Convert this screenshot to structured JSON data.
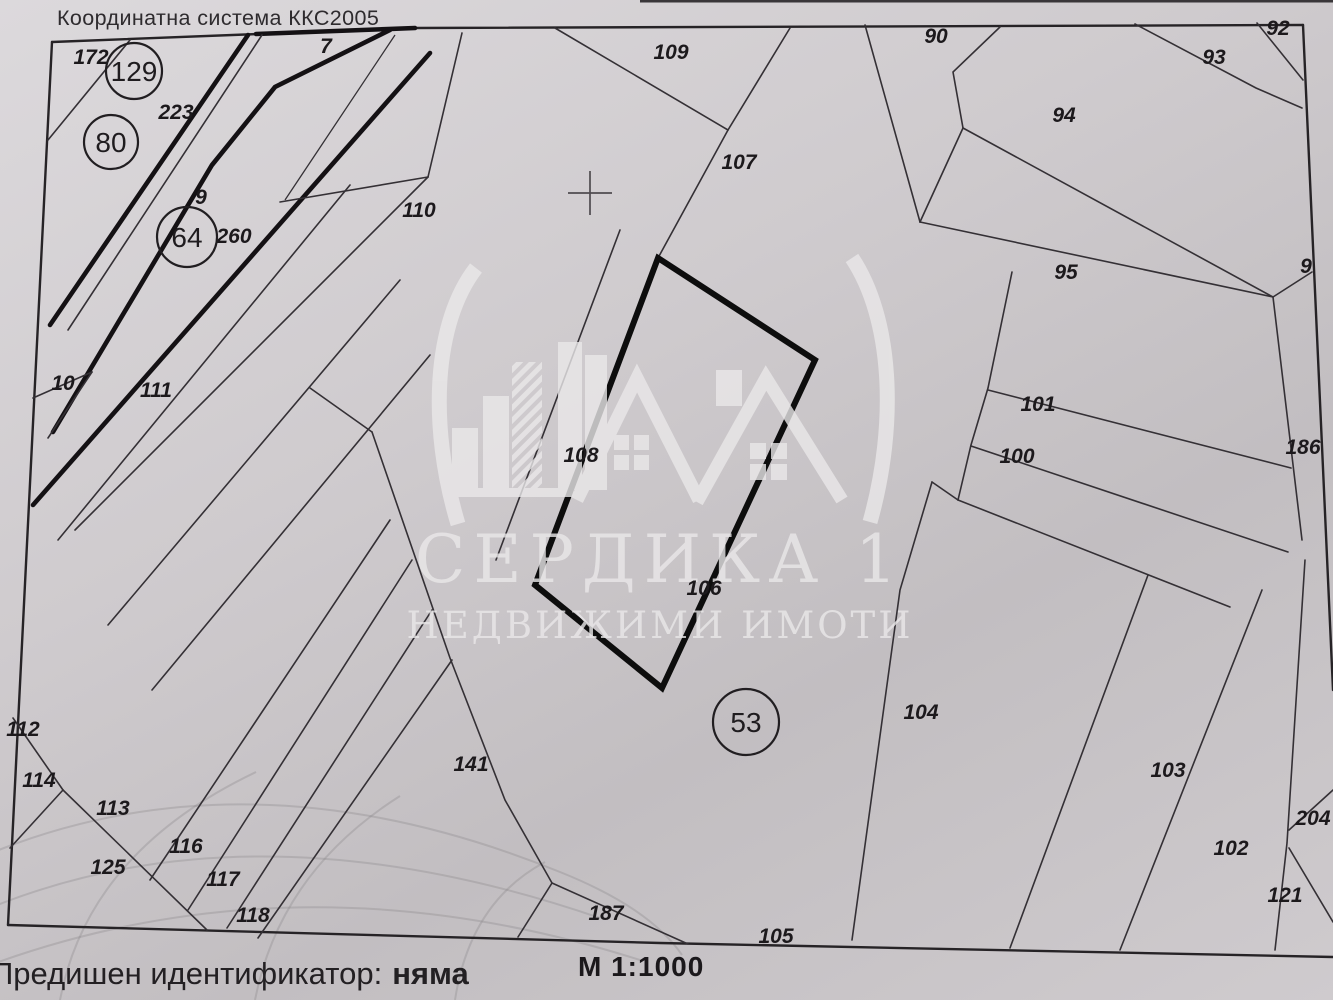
{
  "colors": {
    "paper_light": "#dcd9dc",
    "paper_mid": "#cfcbce",
    "paper_dark": "#c2bec1",
    "ink": "#262326",
    "line": "#343035",
    "bold_line": "#0d0d0d",
    "watermark": "#eae8e9",
    "label": "#1c191c",
    "globe": "#8a868a",
    "text": "#2e2b2e"
  },
  "map": {
    "header": "Координатна система ККС2005",
    "scale_label": "М 1:1000",
    "coordinate_cross": {
      "x": 590,
      "y": 193
    },
    "parcel_labels": [
      {
        "text": "172",
        "x": 91,
        "y": 57
      },
      {
        "text": "223",
        "x": 176,
        "y": 112
      },
      {
        "text": "7",
        "x": 326,
        "y": 46
      },
      {
        "text": "9",
        "x": 201,
        "y": 197
      },
      {
        "text": "260",
        "x": 234,
        "y": 236
      },
      {
        "text": "10",
        "x": 63,
        "y": 383
      },
      {
        "text": "111",
        "x": 156,
        "y": 390
      },
      {
        "text": "110",
        "x": 419,
        "y": 210
      },
      {
        "text": "109",
        "x": 671,
        "y": 52
      },
      {
        "text": "107",
        "x": 739,
        "y": 162
      },
      {
        "text": "90",
        "x": 936,
        "y": 36
      },
      {
        "text": "93",
        "x": 1214,
        "y": 57
      },
      {
        "text": "92",
        "x": 1278,
        "y": 28
      },
      {
        "text": "94",
        "x": 1064,
        "y": 115
      },
      {
        "text": "95",
        "x": 1066,
        "y": 272
      },
      {
        "text": "9",
        "x": 1306,
        "y": 266
      },
      {
        "text": "101",
        "x": 1038,
        "y": 404
      },
      {
        "text": "100",
        "x": 1017,
        "y": 456
      },
      {
        "text": "186",
        "x": 1303,
        "y": 447
      },
      {
        "text": "108",
        "x": 581,
        "y": 455
      },
      {
        "text": "106",
        "x": 704,
        "y": 588
      },
      {
        "text": "104",
        "x": 921,
        "y": 712
      },
      {
        "text": "103",
        "x": 1168,
        "y": 770
      },
      {
        "text": "204",
        "x": 1313,
        "y": 818
      },
      {
        "text": "102",
        "x": 1231,
        "y": 848
      },
      {
        "text": "121",
        "x": 1285,
        "y": 895
      },
      {
        "text": "112",
        "x": 23,
        "y": 729
      },
      {
        "text": "114",
        "x": 39,
        "y": 780
      },
      {
        "text": "113",
        "x": 113,
        "y": 808
      },
      {
        "text": "125",
        "x": 108,
        "y": 867
      },
      {
        "text": "116",
        "x": 186,
        "y": 846
      },
      {
        "text": "117",
        "x": 223,
        "y": 879
      },
      {
        "text": "118",
        "x": 253,
        "y": 915
      },
      {
        "text": "141",
        "x": 471,
        "y": 764
      },
      {
        "text": "187",
        "x": 606,
        "y": 913
      },
      {
        "text": "105",
        "x": 776,
        "y": 936
      }
    ],
    "circled_labels": [
      {
        "text": "129",
        "x": 134,
        "y": 71,
        "r": 28
      },
      {
        "text": "80",
        "x": 111,
        "y": 142,
        "r": 27
      },
      {
        "text": "64",
        "x": 187,
        "y": 237,
        "r": 30
      },
      {
        "text": "53",
        "x": 746,
        "y": 722,
        "r": 33
      }
    ]
  },
  "watermark": {
    "title": "СЕРДИКА 1",
    "subtitle": "НЕДВИЖИМИ ИМОТИ"
  },
  "footer": {
    "label": "Предишен идентификатор:",
    "value": "няма"
  }
}
